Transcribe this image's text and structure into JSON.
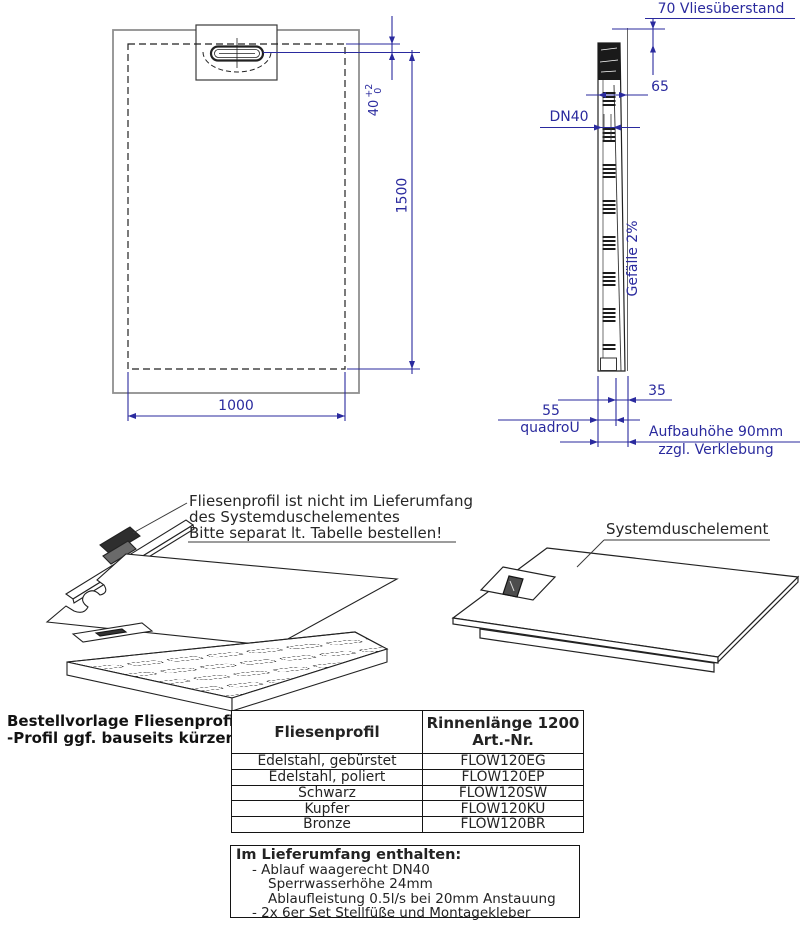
{
  "colors": {
    "dimension": "#2a2a9e",
    "ink": "#1f1f1f"
  },
  "plan_view": {
    "width_dim": "1000",
    "length_dim": "1500",
    "drain_offset_dim": "40",
    "tolerance_upper": "+2",
    "tolerance_lower": "0"
  },
  "side_view": {
    "fleece_label": "70 Vliesüberstand",
    "edge_dim": "65",
    "drain_label": "DN40",
    "slope_label": "Gefälle 2%",
    "top_thickness_dim": "35",
    "base_thickness_dim": "55",
    "brand_label": "quadroU",
    "height_label_line1": "Aufbauhöhe 90mm",
    "height_label_line2": "zzgl. Verklebung"
  },
  "exploded_view": {
    "profile_note_line1": "Fliesenprofil ist nicht im Lieferumfang",
    "profile_note_line2": "des Systemduschelementes",
    "profile_note_line3": "Bitte separat lt. Tabelle bestellen!",
    "element_label": "Systemduschelement"
  },
  "order_table": {
    "caption_line1": "Bestellvorlage Fliesenprofil",
    "caption_line2": "-Profil ggf. bauseits kürzen-",
    "col1_header": "Fliesenprofil",
    "col2_header_line1": "Rinnenlänge 1200",
    "col2_header_line2": "Art.-Nr.",
    "rows": [
      {
        "profile": "Edelstahl, gebürstet",
        "art_nr": "FLOW120EG"
      },
      {
        "profile": "Edelstahl, poliert",
        "art_nr": "FLOW120EP"
      },
      {
        "profile": "Schwarz",
        "art_nr": "FLOW120SW"
      },
      {
        "profile": "Kupfer",
        "art_nr": "FLOW120KU"
      },
      {
        "profile": "Bronze",
        "art_nr": "FLOW120BR"
      }
    ]
  },
  "included_box": {
    "title": "Im Lieferumfang enthalten:",
    "items": [
      "- Ablauf waagerecht DN40",
      "Sperrwasserhöhe 24mm",
      "Ablaufleistung 0.5l/s bei 20mm Anstauung",
      "- 2x 6er Set Stellfüße und Montagekleber"
    ]
  }
}
